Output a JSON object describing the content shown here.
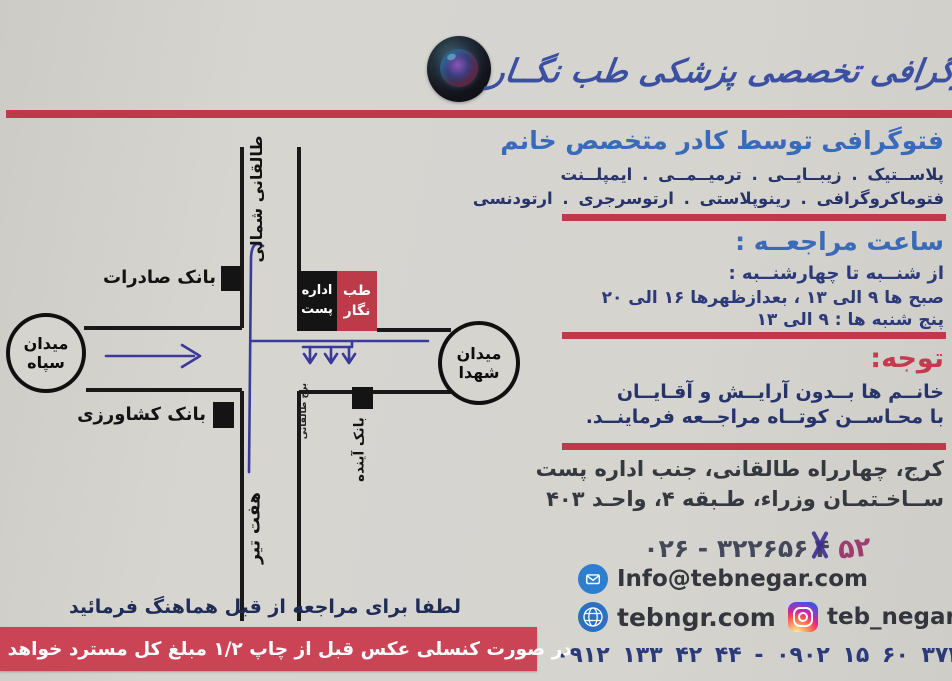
{
  "colors": {
    "accent_red": "#c0394b",
    "title_blue": "#3a6ab8",
    "route_blue": "#3a3a9c",
    "banner_red": "#ca4456",
    "tebnegar_red": "#bd3a49"
  },
  "header": {
    "brand": "فتوگرافی تخصصی پزشکی طب نگــار"
  },
  "map": {
    "taleghani_north": "طالقانی شمالی",
    "haft_tir": "هفت تیر",
    "taleghani_tower": "برج طالقانی",
    "sepah": {
      "l1": "میدان",
      "l2": "سپاه"
    },
    "shohada": {
      "l1": "میدان",
      "l2": "شهدا"
    },
    "bank_saderat": "بانک صادرات",
    "bank_keshavarzi": "بانک کشاورزی",
    "bank_ayandeh": "بانک آینده",
    "post_office": {
      "l1": "اداره",
      "l2": "پست"
    },
    "teb_negar": {
      "l1": "طب",
      "l2": "نگار"
    }
  },
  "services": {
    "title": "فتوگرافی توسط کادر متخصص خانم",
    "line1": "پلاســتیک . زیبــایــی . ترمیــمــی . ایمپلــنت",
    "line2": "فتوماکروگرافی . رینوپلاستی . ارتوسرجری . ارتودنسی"
  },
  "hours": {
    "title": "ساعت مراجعــه :",
    "line1": "از شنــبه تا چهارشنــبه :",
    "line2": "صبح ها ۹ الی ۱۳ ، بعدازظهرها ۱۶ الی ۲۰",
    "line3": "پنج شنبه ها : ۹ الی ۱۳"
  },
  "notice": {
    "title": "توجه:",
    "line1": "خانــم ها بــدون آرایــش و آقـایــان",
    "line2": "با محـاســن کوتــاه مراجــعه فرماینــد."
  },
  "address": {
    "line1": "کرج، چهارراه طالقانی، جنب اداره پست",
    "line2": "ســاخـتمـان وزراء، طـبقه ۴، واحـد ۴۰۳"
  },
  "contact": {
    "phone_prefix": "۰۲۶ - ۳۲۲۶۵۶",
    "phone_crossed": "۴",
    "phone_correction": "۵۲",
    "email": "Info@tebnegar.com",
    "website": "tebngr.com",
    "instagram": "teb_negar",
    "mobiles": "۰۹۱۲ ۱۳۳ ۴۲ ۴۴  -  ۰۹۰۲ ۱۵ ۶۰ ۳۷۳"
  },
  "footer": {
    "note": "لطفا برای مراجعه از قبل هماهنگ فرمائید",
    "refund": "در صورت کنسلی عکس قبل از چاپ ۱/۲ مبلغ کل مسترد خواهد شد."
  }
}
